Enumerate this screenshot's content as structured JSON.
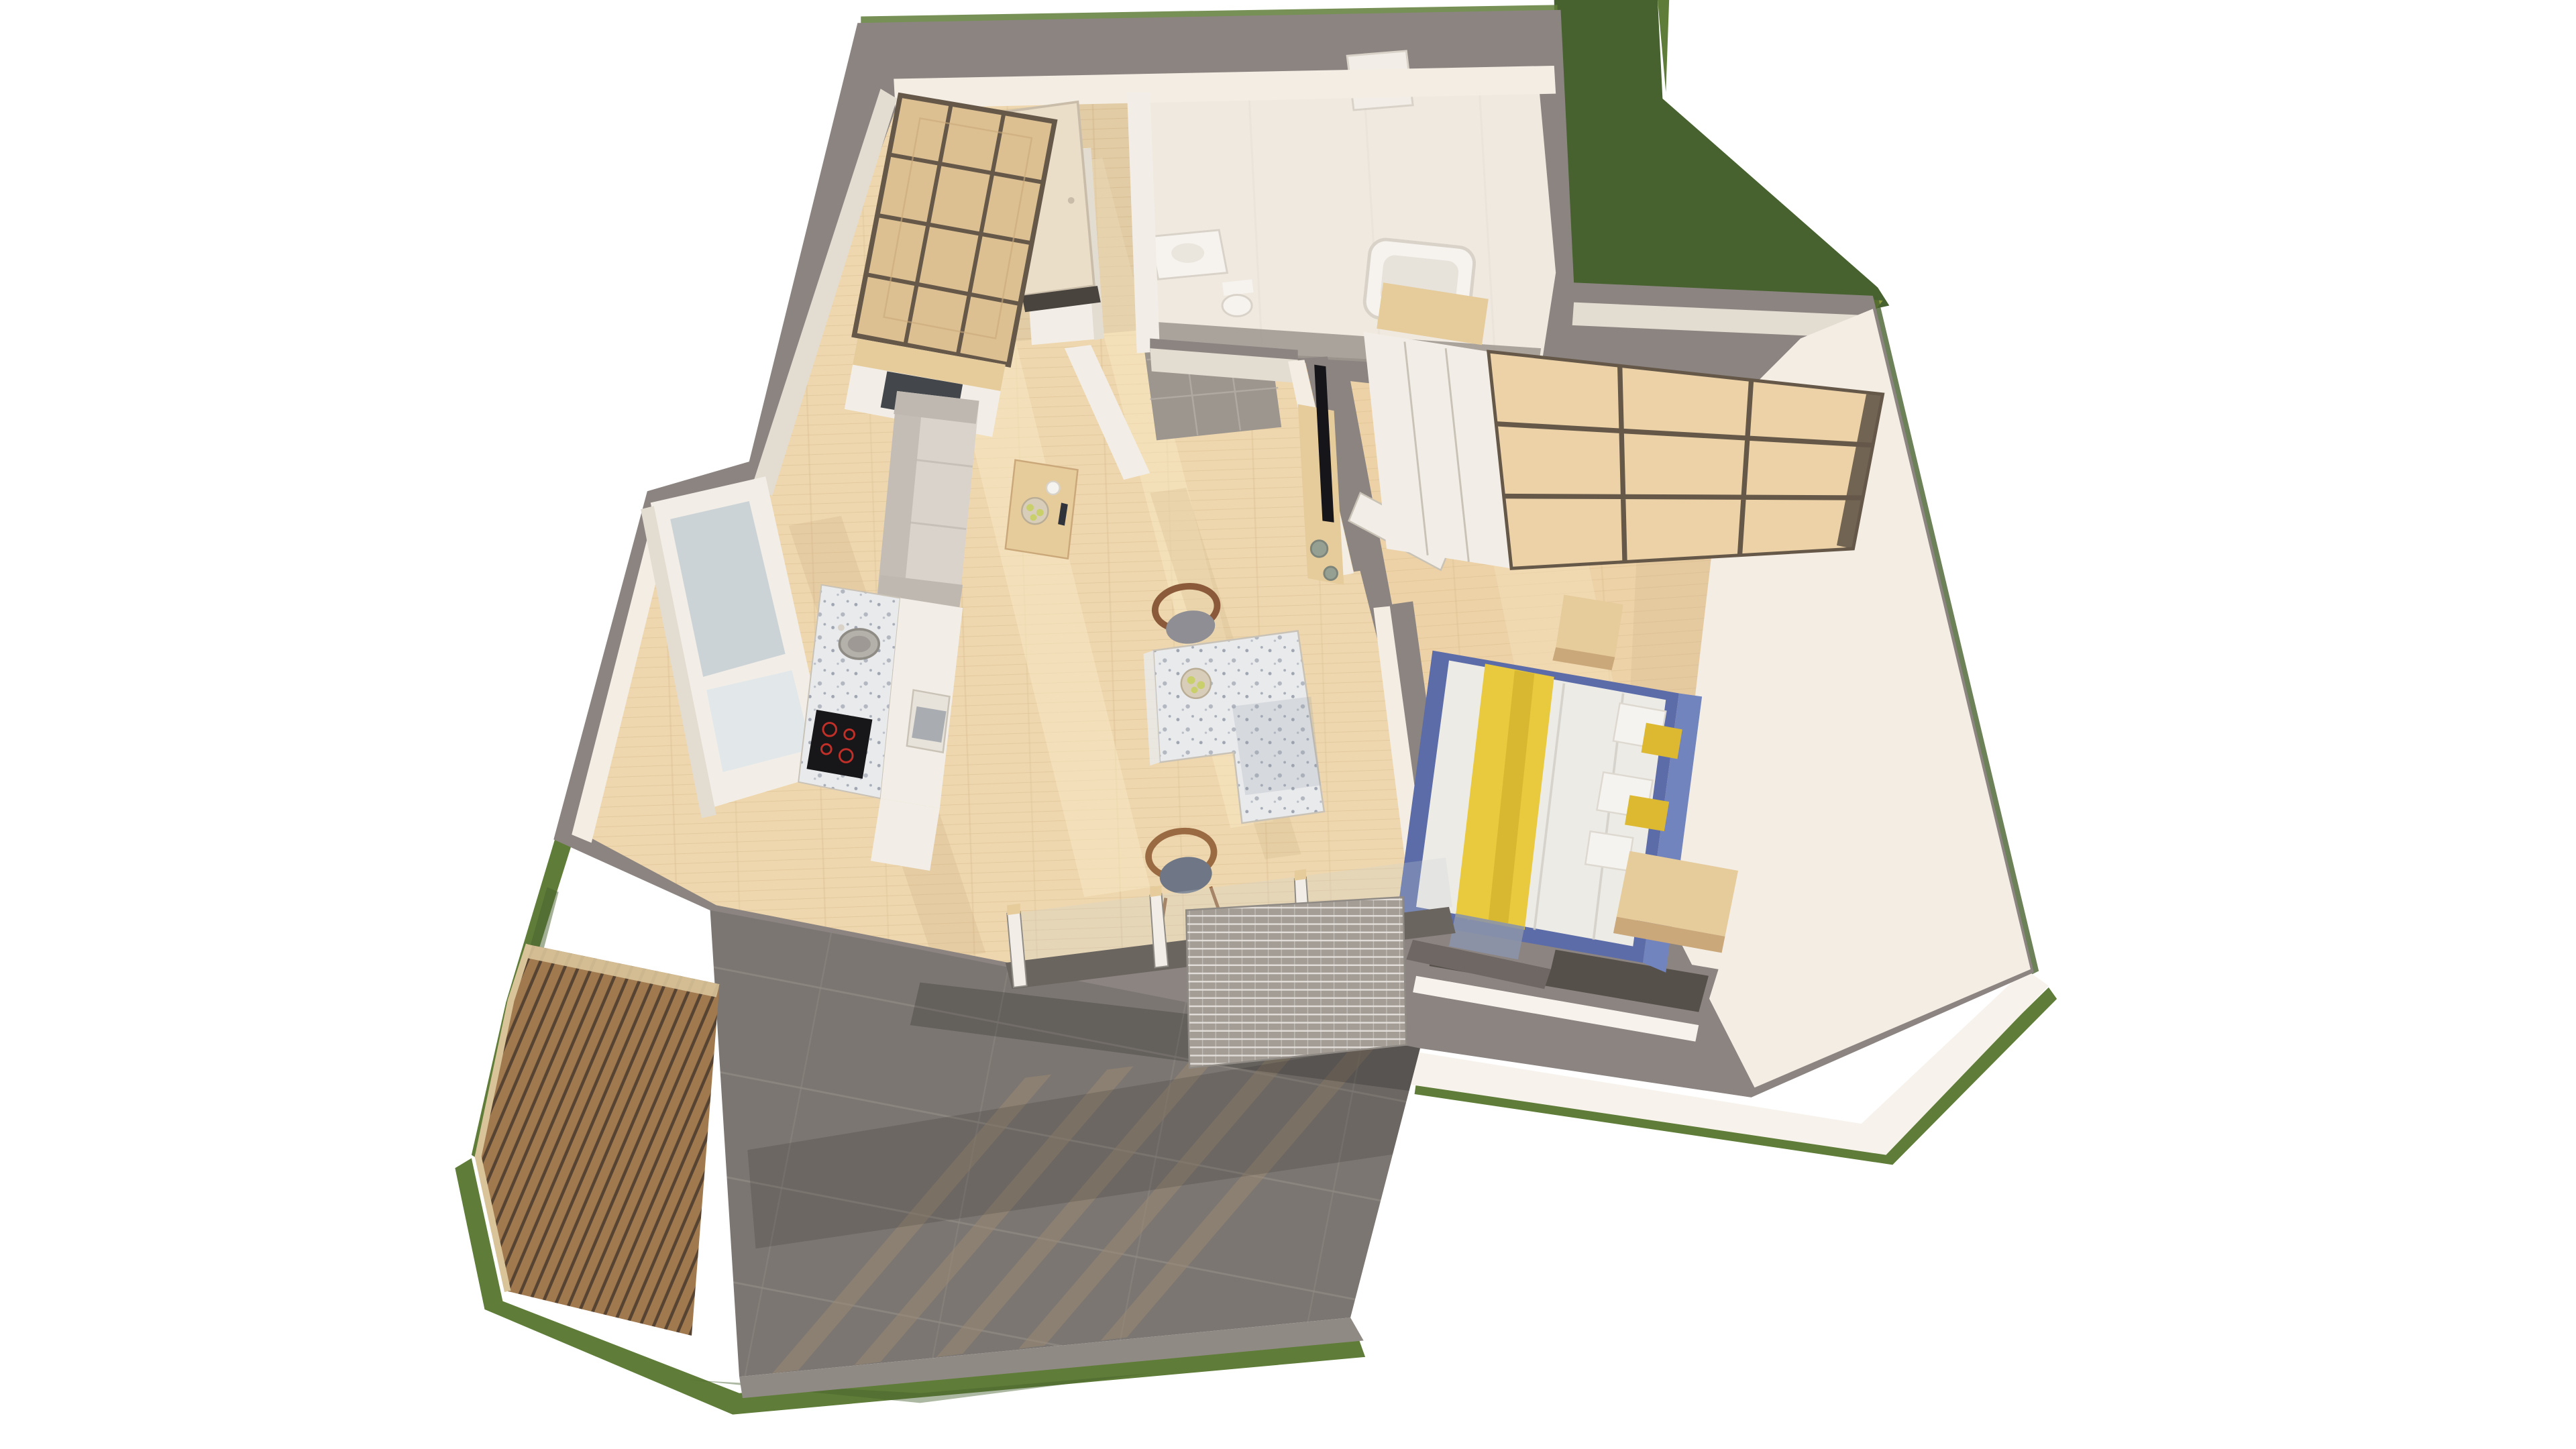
{
  "scene": {
    "description": "3D isometric cutaway floor-plan render of a one-bedroom apartment with terrace and lawn",
    "rooms": [
      {
        "id": "living-kitchen",
        "label": "living room with open kitchen"
      },
      {
        "id": "bedroom",
        "label": "bedroom"
      },
      {
        "id": "bathroom",
        "label": "bathroom"
      },
      {
        "id": "hallway",
        "label": "entrance hallway"
      },
      {
        "id": "terrace",
        "label": "terrace"
      },
      {
        "id": "garden",
        "label": "lawn"
      }
    ],
    "furniture": [
      "diamond-bookshelf",
      "gray-sofa",
      "coffee-table",
      "fruit-bowl",
      "dining-table",
      "dining-chairs",
      "kitchen-counter",
      "induction-cooktop",
      "round-sink",
      "oven",
      "kitchen-window",
      "tall-cabinets",
      "tv",
      "media-console",
      "vases",
      "wardrobe",
      "double-bed",
      "yellow-throw",
      "pillows",
      "nightstand",
      "bench",
      "bathtub",
      "washbasin",
      "toilet",
      "entrance-door",
      "wood-slat-screen",
      "mesh-screen",
      "sliding-door-posts"
    ]
  },
  "colors": {
    "bg": "#ffffff",
    "wall_top": "#8b8481",
    "wall_top_dark": "#6e6763",
    "wall_face": "#f3ede4",
    "wall_face_shadow": "#e3dcd1",
    "bath_wall": "#efe9e0",
    "floor_wood": "#eed7ae",
    "floor_wood_dark": "#d9ba8e",
    "floor_sun": "#f8e9c6",
    "floor_shadow": "#c9a97e",
    "bedroom_wood": "#ecd2a6",
    "hall_tile": "#9d968f",
    "hall_grout": "#b5aea6",
    "terrace_tile": "#7b7671",
    "terrace_tile_light": "#8e8882",
    "terrace_shadow": "#9c8a74",
    "curb": "#908a84",
    "grass_dark": "#47622e",
    "grass_light": "#5f7d38",
    "grass_yellow": "#8a9a3f",
    "slat_wood": "#a1794f",
    "slat_gap": "#4a3a2b",
    "slat_edge": "#d9c49a",
    "white_path": "#f7f3ec",
    "window_glass": "#ccd3d6",
    "window_glass_light": "#e2e8ea",
    "window_dark": "#56504a",
    "frame_white": "#f2eee7",
    "frame_line": "#c9c2b6",
    "terrazzo": "#e9eaec",
    "terrazzo_dot": "#8d95a3",
    "cooktop": "#17171a",
    "burner": "#c03028",
    "sink_metal": "#b4b0aa",
    "sink_rim": "#8f8b85",
    "sofa": "#d9d3cc",
    "sofa_dark": "#bfb8b1",
    "wood_furniture": "#e6cb9b",
    "wood_furniture_dark": "#caa87a",
    "wood_frame": "#655849",
    "shelf_wood": "#dcc092",
    "bed_blue": "#5c6ca8",
    "bed_blue_light": "#7284bd",
    "duvet": "#edebe6",
    "duvet_shadow": "#d0cdc5",
    "throw_yellow": "#e9c93d",
    "throw_yellow_dark": "#cfae2a",
    "throw_tip": "#8b94a9",
    "pillow_white": "#f5f3ef",
    "pillow_yellow": "#dcb930",
    "pillow_line": "#ddd8d0",
    "tv_black": "#15151a",
    "vase_green": "#95a093",
    "vase_line": "#7d857b",
    "door_cream": "#eadec8",
    "door_frame": "#c9bda9",
    "door_sill": "#4a443e",
    "threshold": "#6b6560",
    "mesh": "#a39d96",
    "mesh_line": "#e8e4de",
    "fixture_white": "#f6f3ee",
    "fixture_shadow": "#e7e2da",
    "fixture_line": "#d8d2c9",
    "chair_wood": "#8a5a3a",
    "chair_wood2": "#9a6a42",
    "chair_seat": "#8e8e94",
    "chair_seat2": "#6f7787",
    "fruit_green": "#c9cf6a",
    "bowl": "#d8cdb8",
    "bowl_line": "#b9ad96",
    "oven_glass": "#9aa0a6",
    "display_glass": "#30343a",
    "shade_black": "#000000"
  }
}
